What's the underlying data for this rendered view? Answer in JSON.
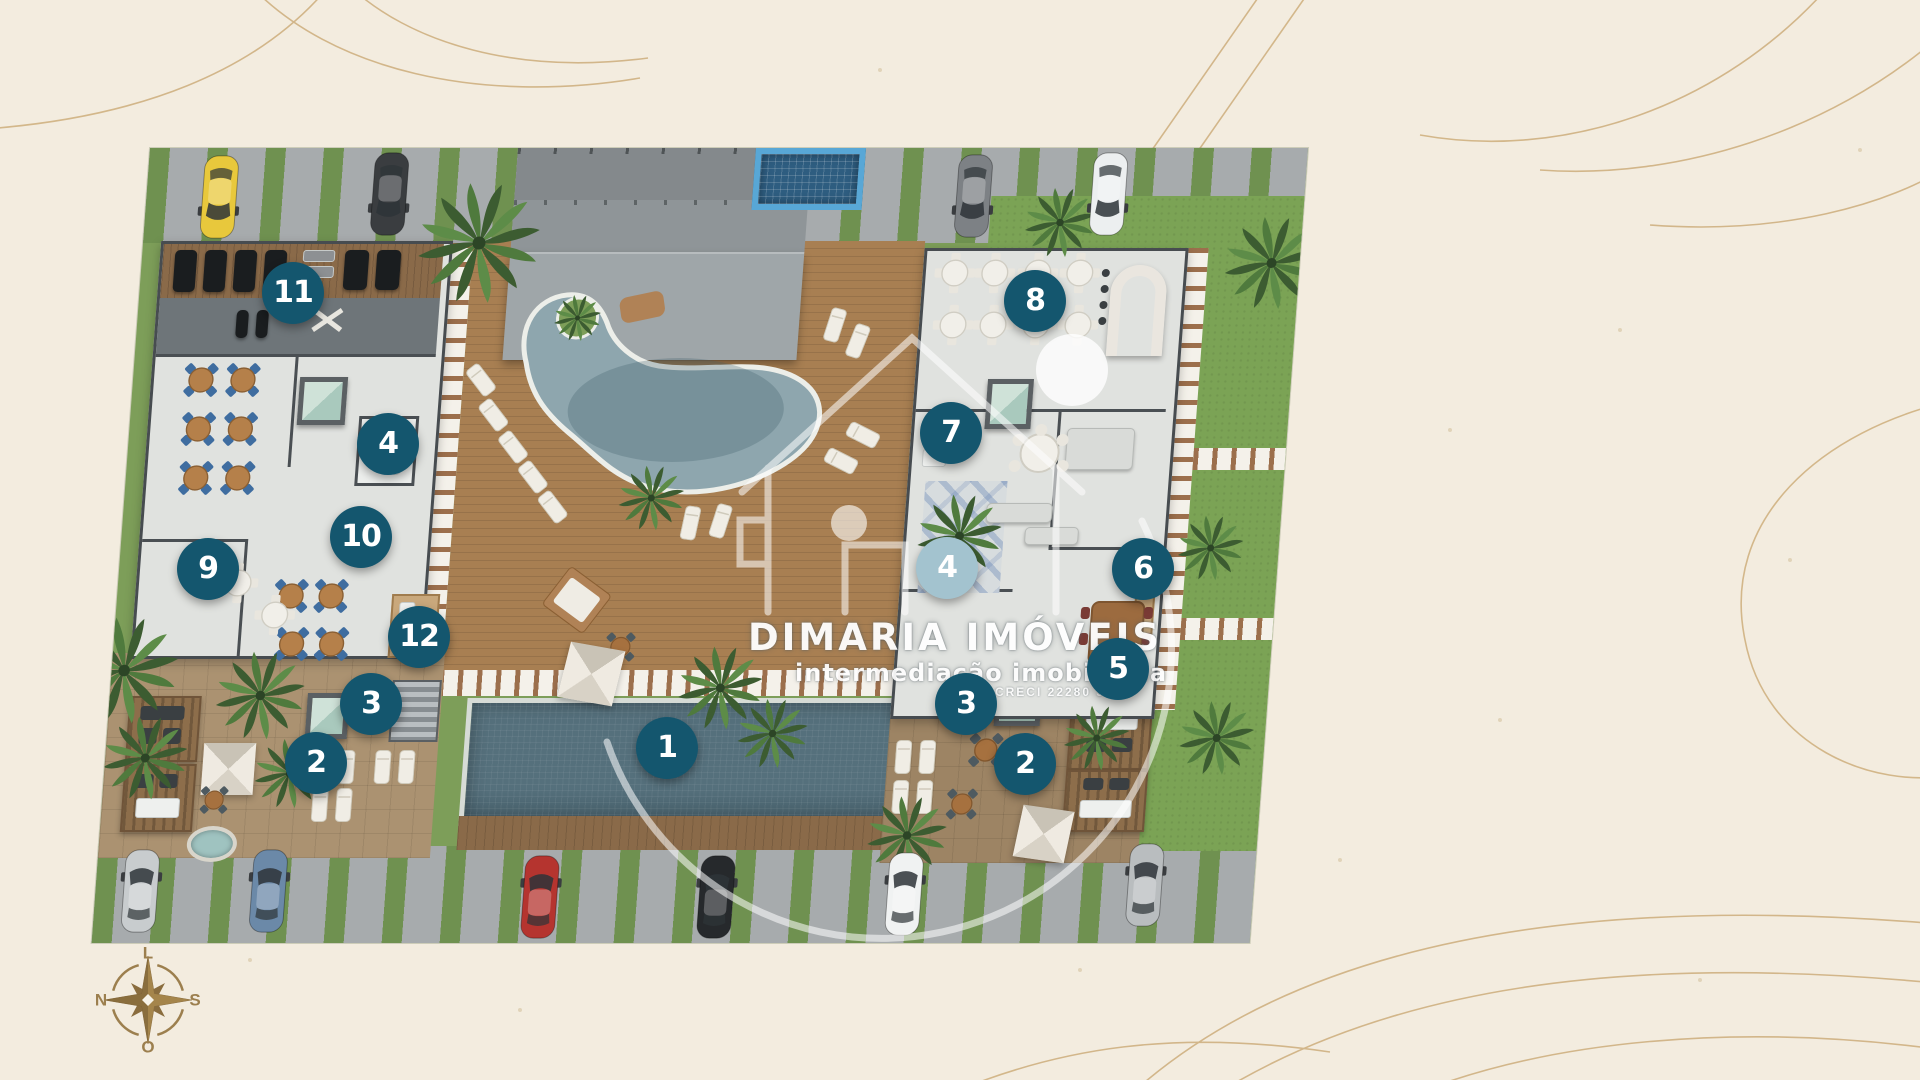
{
  "watermark": {
    "brand": "DIMARIA IMÓVEIS",
    "tagline": "intermediação imobiliária",
    "license": "CRECI 22280 J"
  },
  "compass": {
    "top": "L",
    "right": "S",
    "bottom": "O",
    "left": "N"
  },
  "markers": {
    "fill_dark": "#14566e",
    "fill_light": "#a3c3cf",
    "text_color": "#ffffff",
    "items": [
      {
        "label": "1",
        "x": 667,
        "y": 748,
        "variant": "dark"
      },
      {
        "label": "2",
        "x": 316,
        "y": 763,
        "variant": "dark"
      },
      {
        "label": "2",
        "x": 1025,
        "y": 764,
        "variant": "dark"
      },
      {
        "label": "3",
        "x": 371,
        "y": 704,
        "variant": "dark"
      },
      {
        "label": "3",
        "x": 966,
        "y": 704,
        "variant": "dark"
      },
      {
        "label": "4",
        "x": 388,
        "y": 444,
        "variant": "dark"
      },
      {
        "label": "4",
        "x": 947,
        "y": 568,
        "variant": "light"
      },
      {
        "label": "5",
        "x": 1118,
        "y": 669,
        "variant": "dark"
      },
      {
        "label": "6",
        "x": 1143,
        "y": 569,
        "variant": "dark"
      },
      {
        "label": "7",
        "x": 951,
        "y": 433,
        "variant": "dark"
      },
      {
        "label": "8",
        "x": 1035,
        "y": 301,
        "variant": "dark"
      },
      {
        "label": "9",
        "x": 208,
        "y": 569,
        "variant": "dark"
      },
      {
        "label": "10",
        "x": 361,
        "y": 537,
        "variant": "dark"
      },
      {
        "label": "11",
        "x": 293,
        "y": 293,
        "variant": "dark"
      },
      {
        "label": "12",
        "x": 419,
        "y": 637,
        "variant": "dark"
      }
    ]
  },
  "colors": {
    "background": "#f3ecdf",
    "decor_line": "#c8a56e",
    "compass_gold": "#9c7f4e",
    "grass": "#7ba355",
    "deck_wood": "#a87f52",
    "roof_gray": "#9fa6a9",
    "lap_pool_water": "#55707c",
    "free_pool_water": "#8ea6ae",
    "spa_tile": "#58a7d6"
  }
}
